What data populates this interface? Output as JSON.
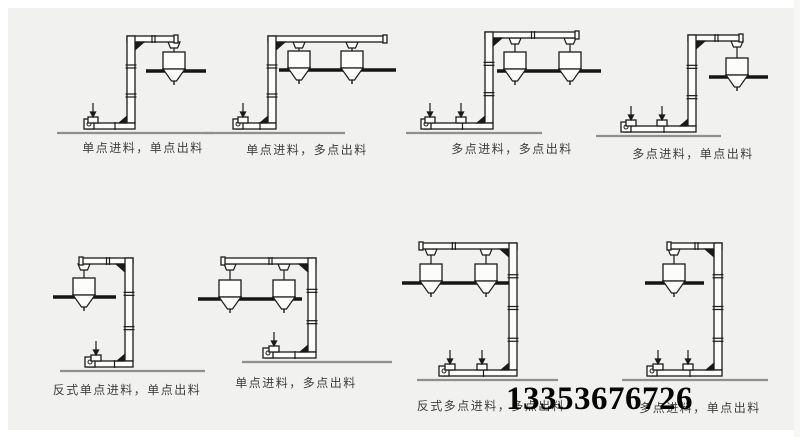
{
  "page": {
    "background": "#f1f1ef",
    "line_color": "#1b1b1b",
    "fill_color": "#fcfcfb",
    "platform_color": "#161616",
    "ground_color": "#8f8f8f",
    "caption_color": "#3f3f3f"
  },
  "phone": {
    "number": "13353676726",
    "pos": [
      506,
      383
    ]
  },
  "diagrams": [
    {
      "caption": "单点进料，单点出料",
      "shape": "z",
      "feeds_count": 1,
      "hoppers_count": 1,
      "geo": {
        "ground": [
          57,
          213,
          133
        ],
        "platform": [
          146,
          206,
          71
        ],
        "col_x": 131,
        "top_y": 36,
        "arm_to": 177,
        "bot_from": 87,
        "feeds": [
          93
        ],
        "hoppers": [
          174
        ],
        "caption_pos": [
          143,
          139
        ]
      }
    },
    {
      "caption": "单点进料，多点出料",
      "shape": "z",
      "feeds_count": 1,
      "hoppers_count": 2,
      "geo": {
        "ground": [
          204,
          345,
          133
        ],
        "platform": [
          279,
          396,
          70
        ],
        "col_x": 272,
        "top_y": 36,
        "arm_to": 386,
        "bot_from": 236,
        "feeds": [
          243
        ],
        "hoppers": [
          299,
          352
        ],
        "caption_pos": [
          307,
          141
        ]
      }
    },
    {
      "caption": "多点进料，多点出料",
      "shape": "z",
      "feeds_count": 2,
      "hoppers_count": 2,
      "geo": {
        "ground": [
          406,
          542,
          133
        ],
        "platform": [
          497,
          601,
          71
        ],
        "col_x": 489,
        "top_y": 32,
        "arm_to": 578,
        "bot_from": 424,
        "feeds": [
          430,
          461
        ],
        "hoppers": [
          515,
          570
        ],
        "caption_pos": [
          512,
          140
        ]
      }
    },
    {
      "caption": "多点进料，单点出料",
      "shape": "z",
      "feeds_count": 2,
      "hoppers_count": 1,
      "geo": {
        "ground": [
          596,
          721,
          136
        ],
        "platform": [
          709,
          768,
          77
        ],
        "col_x": 692,
        "top_y": 35,
        "arm_to": 742,
        "bot_from": 624,
        "feeds": [
          631,
          662
        ],
        "hoppers": [
          737
        ],
        "caption_pos": [
          693,
          145
        ]
      }
    },
    {
      "caption": "反式单点进料，单点出料",
      "shape": "c",
      "feeds_count": 1,
      "hoppers_count": 1,
      "geo": {
        "ground": [
          60,
          205,
          371
        ],
        "platform": [
          53,
          116,
          297
        ],
        "col_x": 129,
        "top_y": 258,
        "arm_to": 80,
        "bot_from": 88,
        "feeds": [
          96
        ],
        "hoppers": [
          84
        ],
        "caption_pos": [
          127,
          381
        ]
      }
    },
    {
      "caption": "单点进料，多点出料",
      "shape": "c",
      "feeds_count": 1,
      "hoppers_count": 2,
      "geo": {
        "ground": [
          242,
          392,
          362
        ],
        "platform": [
          198,
          302,
          299
        ],
        "col_x": 312,
        "top_y": 258,
        "arm_to": 222,
        "bot_from": 266,
        "feeds": [
          274
        ],
        "hoppers": [
          230,
          284
        ],
        "caption_pos": [
          296,
          374
        ]
      }
    },
    {
      "caption": "反式多点进料，多点出料",
      "shape": "c",
      "feeds_count": 2,
      "hoppers_count": 2,
      "geo": {
        "ground": [
          417,
          558,
          380
        ],
        "platform": [
          402,
          512,
          283
        ],
        "col_x": 513,
        "top_y": 243,
        "arm_to": 420,
        "bot_from": 442,
        "feeds": [
          450,
          482
        ],
        "hoppers": [
          431,
          486
        ],
        "caption_pos": [
          491,
          397
        ]
      }
    },
    {
      "caption": "多点进料，单点出料",
      "shape": "c",
      "feeds_count": 2,
      "hoppers_count": 1,
      "geo": {
        "ground": [
          622,
          768,
          380
        ],
        "platform": [
          645,
          704,
          283
        ],
        "col_x": 718,
        "top_y": 243,
        "arm_to": 668,
        "bot_from": 650,
        "feeds": [
          658,
          688
        ],
        "hoppers": [
          674
        ],
        "caption_pos": [
          700,
          399
        ]
      }
    }
  ]
}
